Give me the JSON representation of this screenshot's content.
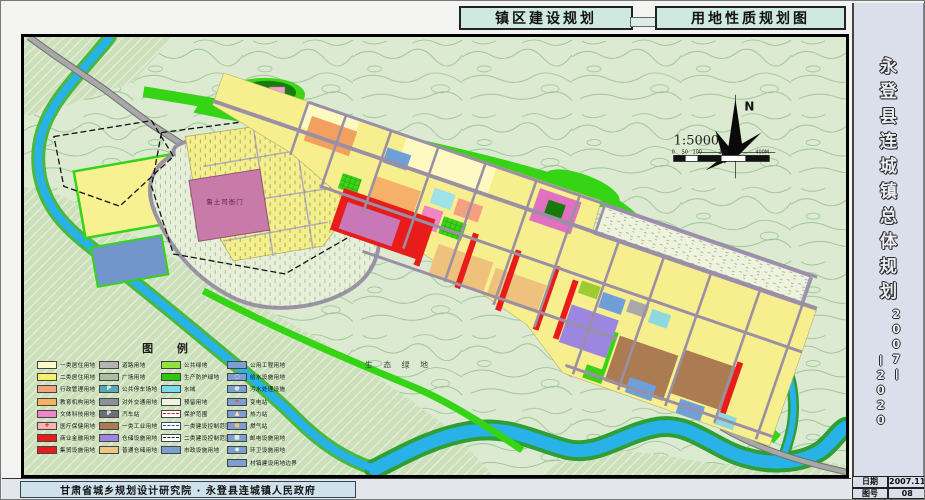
{
  "header": {
    "title_left": "镇区建设规划",
    "title_right": "用地性质规划图"
  },
  "sidebar": {
    "title_chars": "永登县连城镇总体规划",
    "year_top": "2007",
    "year_bottom": "2020",
    "dash": "—",
    "date_label": "日期",
    "date_value": "2007.11",
    "sheet_label": "图号",
    "sheet_value": "08"
  },
  "footer": {
    "institute": "甘肃省城乡规划设计研究院 · 永登县连城镇人民政府"
  },
  "map": {
    "labels": {
      "heritage": "鲁土司衙门",
      "eco": "生 态 绿 地",
      "north": "N",
      "scale": "1:5000"
    },
    "scale_ticks": [
      "0",
      "50",
      "100",
      "200",
      "400M"
    ]
  },
  "legend": {
    "title": "图  例",
    "columns": [
      {
        "items": [
          {
            "label": "一类居住用地",
            "color": "#fdfbc8"
          },
          {
            "label": "二类居住用地",
            "color": "#f8ef6e"
          },
          {
            "label": "行政管理用地",
            "color": "#f2a47c"
          },
          {
            "label": "教育机构用地",
            "color": "#f5b160"
          },
          {
            "label": "文体科技用地",
            "color": "#ee86c8"
          },
          {
            "label": "医疗保健用地",
            "color": "#f8b4b4",
            "symbol": "+",
            "symbol_color": "#d00000"
          },
          {
            "label": "商业金融用地",
            "color": "#e91c1c"
          },
          {
            "label": "集贸设施用地",
            "color": "#e91c1c",
            "pattern": "hatch-white"
          }
        ]
      },
      {
        "items": [
          {
            "label": "道路用地",
            "color": "#b4b4b4"
          },
          {
            "label": "广场用地",
            "color": "#a9bfa0",
            "pattern": "dots"
          },
          {
            "label": "公共停车场地",
            "color": "#55aab8",
            "symbol": "P",
            "symbol_color": "#ffffff"
          },
          {
            "label": "对外交通用地",
            "color": "#8f9097"
          },
          {
            "label": "汽车站",
            "color": "#6e7076",
            "symbol": "P",
            "symbol_color": "#ffffff"
          },
          {
            "label": "一类工业用地",
            "color": "#ab7b52"
          },
          {
            "label": "仓储设施用地",
            "color": "#9c86e0"
          },
          {
            "label": "普通仓储用地",
            "color": "#ecc684"
          }
        ]
      },
      {
        "items": [
          {
            "label": "公共绿地",
            "color": "#8fe23f"
          },
          {
            "label": "生产防护绿地",
            "color": "#2fc513"
          },
          {
            "label": "水域",
            "color": "#7adbee"
          },
          {
            "label": "预留用地",
            "color": "#eff3e2"
          },
          {
            "label": "保护范围",
            "color": "#ffffff",
            "line": "dash-red"
          },
          {
            "label": "一类建设控制范围",
            "color": "#ffffff",
            "line": "dd-blue"
          },
          {
            "label": "二类建设控制范围",
            "color": "#ffffff",
            "line": "dd-dark"
          },
          {
            "label": "市政设施用地",
            "color": "#7c9ed2"
          }
        ]
      },
      {
        "items": [
          {
            "label": "公用工程用地",
            "color": "#7c9ed2"
          },
          {
            "label": "给水设施用地",
            "color": "#7c9ed2",
            "symbol": "○",
            "symbol_color": "#eaf4ff"
          },
          {
            "label": "污水处理设施",
            "color": "#7c9ed2",
            "symbol": "●",
            "symbol_color": "#cfe8f0"
          },
          {
            "label": "变电站",
            "color": "#7c9ed2",
            "symbol": "+",
            "symbol_color": "#ff3030"
          },
          {
            "label": "热力站",
            "color": "#7c9ed2",
            "symbol": "▲",
            "symbol_color": "#ffe8a0"
          },
          {
            "label": "燃气站",
            "color": "#7c9ed2",
            "symbol": "●",
            "symbol_color": "#ffc070"
          },
          {
            "label": "邮电设施用地",
            "color": "#7c9ed2",
            "symbol": "■",
            "symbol_color": "#d8f0e0"
          },
          {
            "label": "环卫设施用地",
            "color": "#7c9ed2",
            "symbol": "◆",
            "symbol_color": "#e8ffe8"
          },
          {
            "label": "村镇建设用地边界",
            "color": "#7c9ed2",
            "pattern": "hatch-white"
          }
        ]
      }
    ]
  },
  "colors": {
    "residential_yellow": "#f7ef8e",
    "bright_green": "#35d414",
    "river_blue": "#28b2e8",
    "heritage_mauve": "#c87ba9",
    "commercial_red": "#e91c1c",
    "industry_brown": "#ab7b52",
    "warehouse_purple": "#9c86e0",
    "sidebar_bg": "#dbdeeb",
    "title_bg": "#cfe9e0"
  }
}
